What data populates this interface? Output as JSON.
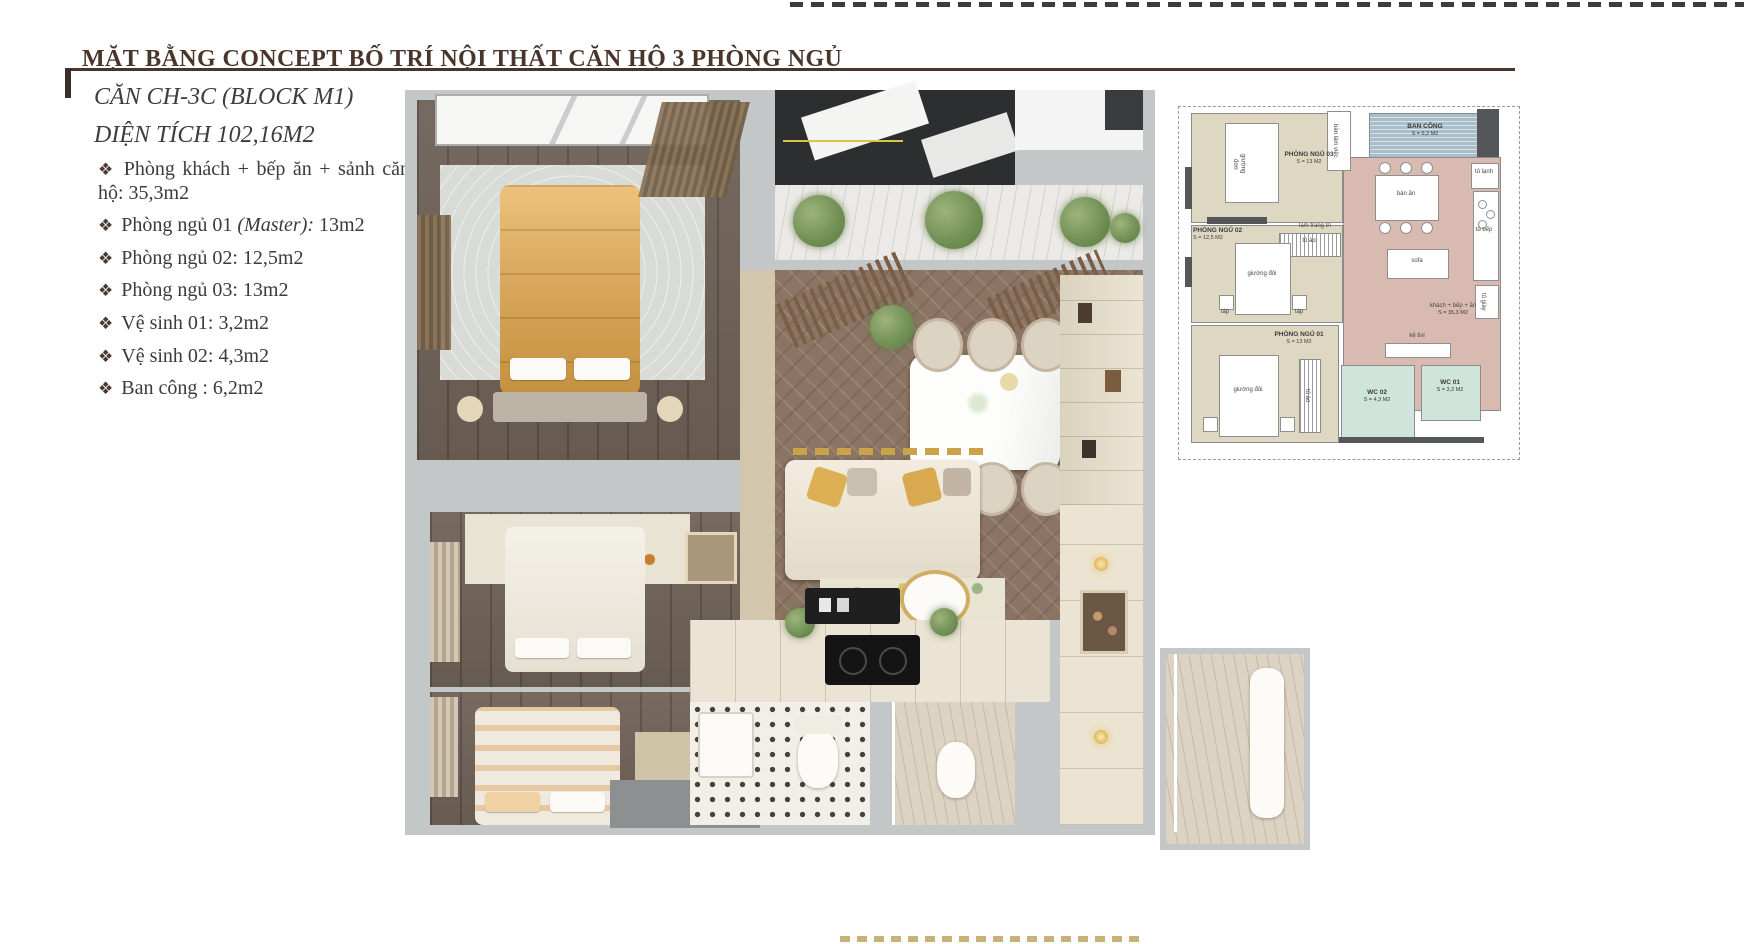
{
  "title": "MẶT BẰNG CONCEPT BỐ TRÍ NỘI THẤT CĂN HỘ 3 PHÒNG NGỦ",
  "info": {
    "unit_name": "CĂN CH-3C (BLOCK M1)",
    "area_line": "DIỆN TÍCH 102,16M2",
    "bullet_glyph": "❖",
    "rooms": [
      {
        "pre": "Phòng khách + bếp ăn + sảnh căn hộ: 35,3m2",
        "em": "",
        "post": ""
      },
      {
        "pre": "Phòng ngủ 01 ",
        "em": "(Master):",
        "post": " 13m2"
      },
      {
        "pre": "Phòng ngủ 02: 12,5m2",
        "em": "",
        "post": ""
      },
      {
        "pre": "Phòng ngủ 03: 13m2",
        "em": "",
        "post": ""
      },
      {
        "pre": "Vệ sinh 01: 3,2m2",
        "em": "",
        "post": ""
      },
      {
        "pre": "Vệ sinh 02: 4,3m2",
        "em": "",
        "post": ""
      },
      {
        "pre": "Ban công : 6,2m2",
        "em": "",
        "post": ""
      }
    ]
  },
  "plan": {
    "bedroom3": {
      "name": "PHÒNG NGỦ 03",
      "area": "S = 13 M2"
    },
    "bedroom2": {
      "name": "PHÒNG NGỦ 02",
      "area": "S = 12,5 M2"
    },
    "bedroom1": {
      "name": "PHÒNG NGỦ 01",
      "area": "S = 13 M2"
    },
    "balcony": {
      "name": "BAN CÔNG",
      "area": "S = 6,2 M2"
    },
    "living": {
      "name": "khách + bếp + ăn",
      "area": "S = 35,3 M2"
    },
    "wc1": {
      "name": "WC 01",
      "area": "S = 3,2 M2"
    },
    "wc2": {
      "name": "WC 02",
      "area": "S = 4,3 M2"
    },
    "furniture": {
      "single_bed": "giường đơn",
      "double_bed": "giường đôi",
      "desk": "bàn làm việc",
      "decor_slats": "lam trang trí",
      "wardrobe": "tủ áo",
      "nightstand": "táp",
      "fridge": "tủ lạnh",
      "dining_table": "bàn ăn",
      "kitchen_cabinet": "tủ bếp",
      "sofa": "sofa",
      "shoe_cabinet": "tủ giày",
      "tv_shelf": "kệ tivi"
    }
  },
  "colors": {
    "accent_brown": "#4a352b",
    "body_text": "#3b3b3d",
    "plan_room_beige": "#ded8c3",
    "plan_living_rose": "#d9bab0",
    "plan_wc_teal": "#cfe4da",
    "plan_balcony_blue": "#a9bec9",
    "render_wall_gray": "#c4c7c8",
    "wood_dark": "#6f6258",
    "wood_herringbone": "#8b7463",
    "gold_bed": "#d9a85c"
  }
}
